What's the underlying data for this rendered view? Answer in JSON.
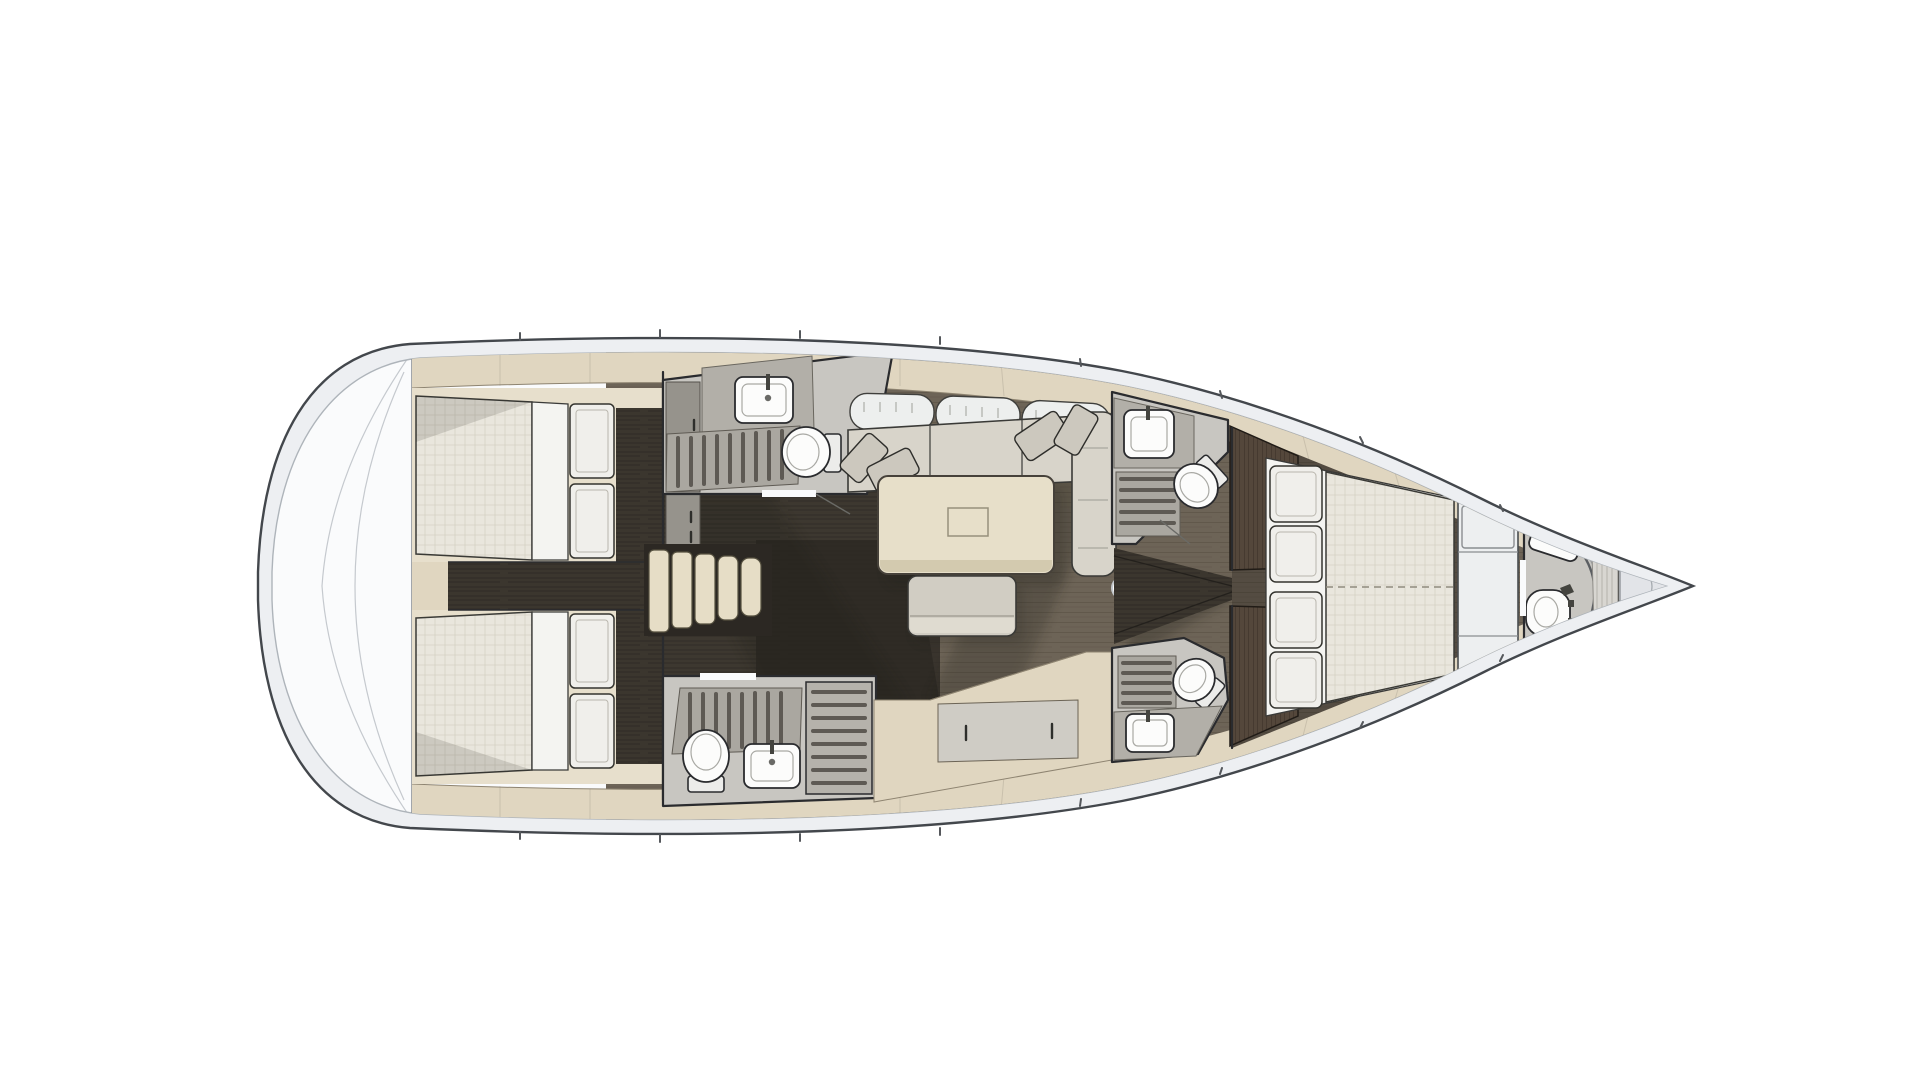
{
  "meta": {
    "title": "Sailboat interior layout plan — top-down view, bow to the right",
    "diagram_type": "yacht-floor-plan",
    "visible_text": []
  },
  "colors": {
    "page-bg": "#ffffff",
    "hull-band": "#edeff2",
    "hull-stroke": "#43474c",
    "deck-white": "#fafbfc",
    "deck-line": "#aeb4ba",
    "trim-beige": "#e0d6c0",
    "trim-edge": "#8e8471",
    "stair-beige": "#e6ddc6",
    "floor-wood": "#6d6457",
    "floor-grain": "#554c3f",
    "corridor-dark": "#3b362e",
    "corridor-darker": "#2c2823",
    "cabin-floor-dark": "#4c443a",
    "mattress": "#e9e6dd",
    "mattress-grid": "#d5d1c4",
    "linen": "#f4f4f1",
    "pillow": "#f0efeb",
    "sofa-cushion": "#d8d4ca",
    "sofa-back": "#edefee",
    "accent-pillow": "#ccc8be",
    "table-wood": "#e7dfc9",
    "table-edge": "#d3caaf",
    "ottoman": "#d1cdc3",
    "ottoman-face": "#dfdbd0",
    "head-floor": "#c8c6c1",
    "vanity": "#b2afa8",
    "cabinet": "#96938c",
    "grate-base": "#aaa7a0",
    "grate-slat": "#5e5a54",
    "fixture": "#fcfcfb",
    "outline": "#2a2b2e",
    "wardrobe": "#54473b",
    "wardrobe-grain": "#3a2f26",
    "shadow": "#1f1b15",
    "mast": "#ffffff",
    "bow-wedge": "#e2e4e8"
  },
  "legend": {
    "orientation": "bow-right",
    "rooms": [
      {
        "id": "stern-platform",
        "name": "stern platform / transom"
      },
      {
        "id": "aft-cabin-port",
        "name": "aft double cabin (top)"
      },
      {
        "id": "aft-cabin-starboard",
        "name": "aft double cabin (bottom)"
      },
      {
        "id": "companionway",
        "name": "companionway stairs + corridor"
      },
      {
        "id": "aft-head-port",
        "name": "aft head with shower (top)"
      },
      {
        "id": "aft-head-starboard",
        "name": "aft head with shower stall (bottom)"
      },
      {
        "id": "salon",
        "name": "salon with sofa, table, ottoman"
      },
      {
        "id": "mid-head-port",
        "name": "mid head (top, at mast)"
      },
      {
        "id": "mid-head-starboard",
        "name": "mid head (bottom, at mast)"
      },
      {
        "id": "forward-cabin",
        "name": "forward cabin with island bed"
      },
      {
        "id": "bow-head",
        "name": "bow head"
      },
      {
        "id": "bow-locker",
        "name": "bow / anchor locker"
      }
    ],
    "fixture_icons": [
      "toilet-icon",
      "sink-icon",
      "shower-grate-icon",
      "shower-stall-icon",
      "mast-post-icon",
      "stairs-icon",
      "bed-pillow-icon",
      "mattress-icon",
      "sofa-icon",
      "table-icon",
      "ottoman-icon",
      "wardrobe-icon",
      "shower-screen-icon"
    ]
  }
}
